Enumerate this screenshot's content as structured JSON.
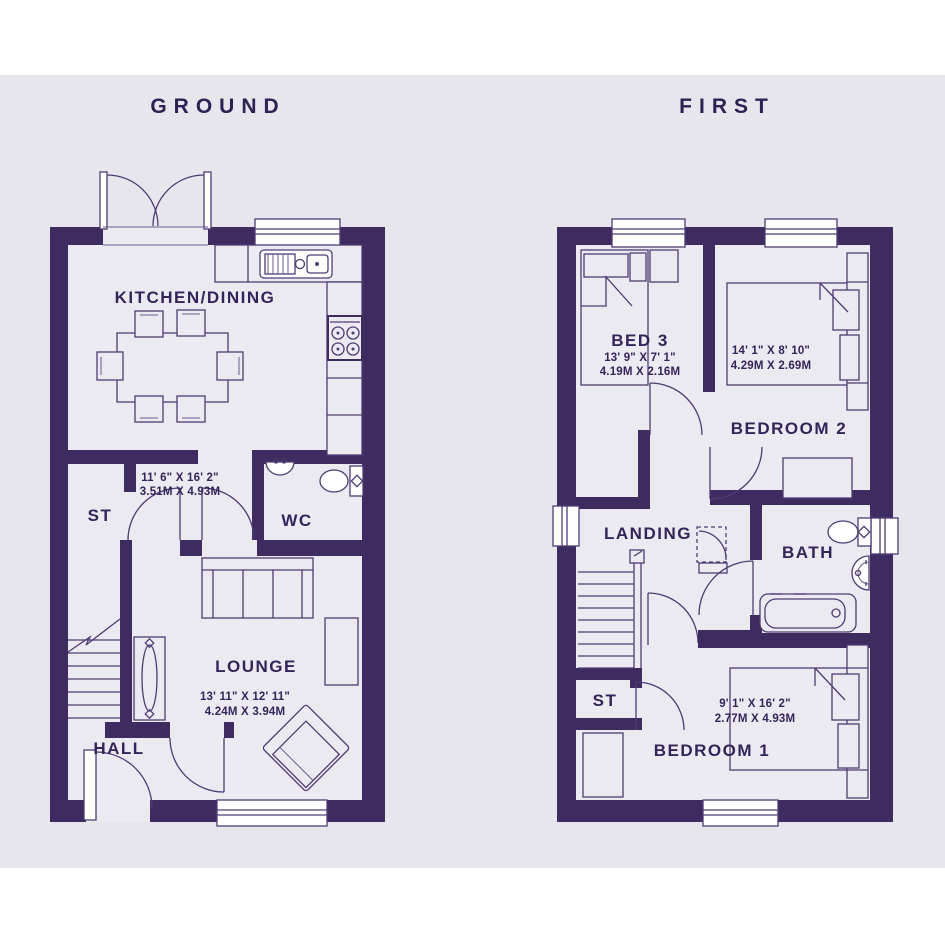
{
  "page": {
    "background_band_color": "#e8e6ed",
    "wall_color": "#3e2b5f",
    "line_color": "#4e3c75",
    "text_color": "#33245a"
  },
  "floors": [
    {
      "id": "ground",
      "title": "GROUND",
      "rooms": [
        {
          "name": "KITCHEN/DINING",
          "imperial": "11' 6\" X 16' 2\"",
          "metric": "3.51M X 4.93M"
        },
        {
          "name": "ST"
        },
        {
          "name": "WC"
        },
        {
          "name": "LOUNGE",
          "imperial": "13' 11\" X 12' 11\"",
          "metric": "4.24M X 3.94M"
        },
        {
          "name": "HALL"
        }
      ]
    },
    {
      "id": "first",
      "title": "FIRST",
      "rooms": [
        {
          "name": "BED 3",
          "imperial": "13' 9\" X 7' 1\"",
          "metric": "4.19M X 2.16M"
        },
        {
          "name": "BEDROOM 2",
          "imperial": "14' 1\" X 8' 10\"",
          "metric": "4.29M X 2.69M"
        },
        {
          "name": "LANDING"
        },
        {
          "name": "BATH"
        },
        {
          "name": "ST"
        },
        {
          "name": "BEDROOM 1",
          "imperial": "9' 1\" X 16' 2\"",
          "metric": "2.77M X 4.93M"
        }
      ]
    }
  ]
}
